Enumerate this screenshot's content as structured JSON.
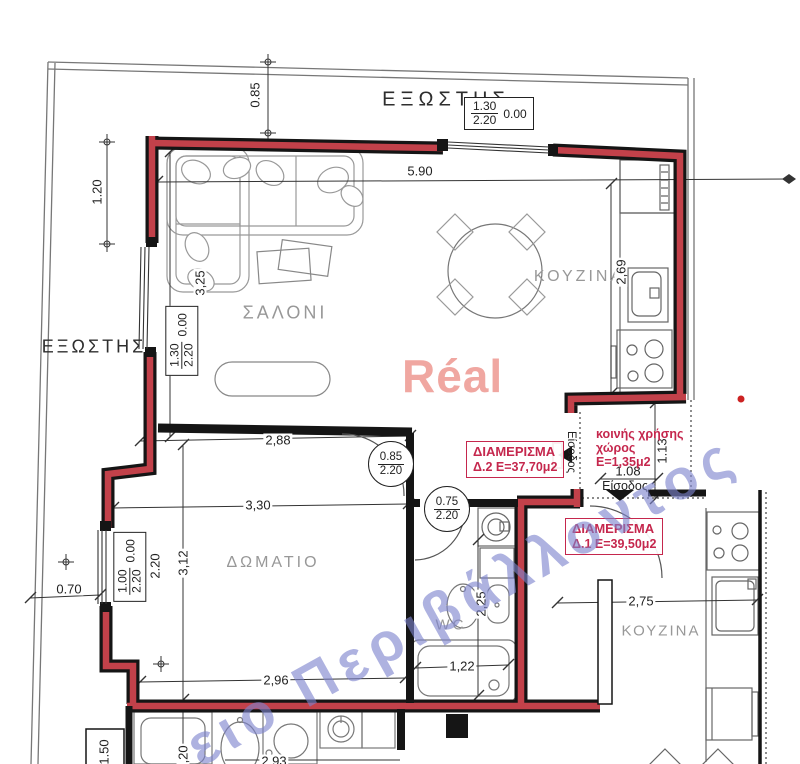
{
  "rooms": {
    "balcony_top": "ΕΞΩΣΤΗΣ",
    "balcony_left": "ΕΞΩΣΤΗΣ",
    "living": "ΣΑΛΟΝΙ",
    "kitchen_top": "ΚΟΥΖΙΝΑ",
    "bedroom": "ΔΩΜΑΤΙΟ",
    "wc": "WC",
    "kitchen_bottom": "ΚΟΥΖΙΝΑ"
  },
  "dims": {
    "v085": "0.85",
    "v120": "1.20",
    "v590": "5.90",
    "v325": "3,25",
    "v269": "2,69",
    "v288": "2,88",
    "v330": "3,30",
    "v312": "3,12",
    "v070": "0.70",
    "v296": "2,96",
    "v225": "2,25",
    "v122": "1,22",
    "v275": "2,75",
    "v113": "1.13",
    "v108": "1.08",
    "v220": "2,20",
    "v293": "2,93",
    "v150": "1.50"
  },
  "tags": {
    "top": {
      "num": "1.30",
      "den": "2.20",
      "side": "0.00"
    },
    "left": {
      "num": "1.30",
      "den": "2.20",
      "side": "0.00"
    },
    "window": {
      "num": "1.00",
      "den": "2.20",
      "side": "0.00",
      "extra": "2.20"
    },
    "door_living": {
      "num": "0.85",
      "den": "2.20"
    },
    "door_wc": {
      "num": "0.75",
      "den": "2.20"
    }
  },
  "apartments": {
    "d2": {
      "title": "ΔΙΑΜΕΡΙΣΜΑ",
      "info": "Δ.2 Ε=37,70μ2"
    },
    "d1": {
      "title": "ΔΙΑΜΕΡΙΣΜΑ",
      "info": "Δ.1  Ε=39,50μ2"
    }
  },
  "common": {
    "l1": "κοινής χρήσης",
    "l2": "χώρος",
    "l3": "Ε=1,35μ2"
  },
  "entrance": {
    "v": "Είσοδος",
    "h": "Είσοδος"
  },
  "watermarks": {
    "brand": "Réal",
    "diagonal": "ειο Περιβάλλοντος"
  },
  "colors": {
    "wall_red": "#c2414a",
    "annotation_red": "#c5274d",
    "watermark_pink": "#f0a7a1",
    "watermark_blue": "#8287cd",
    "room_label_gray": "#989898"
  }
}
